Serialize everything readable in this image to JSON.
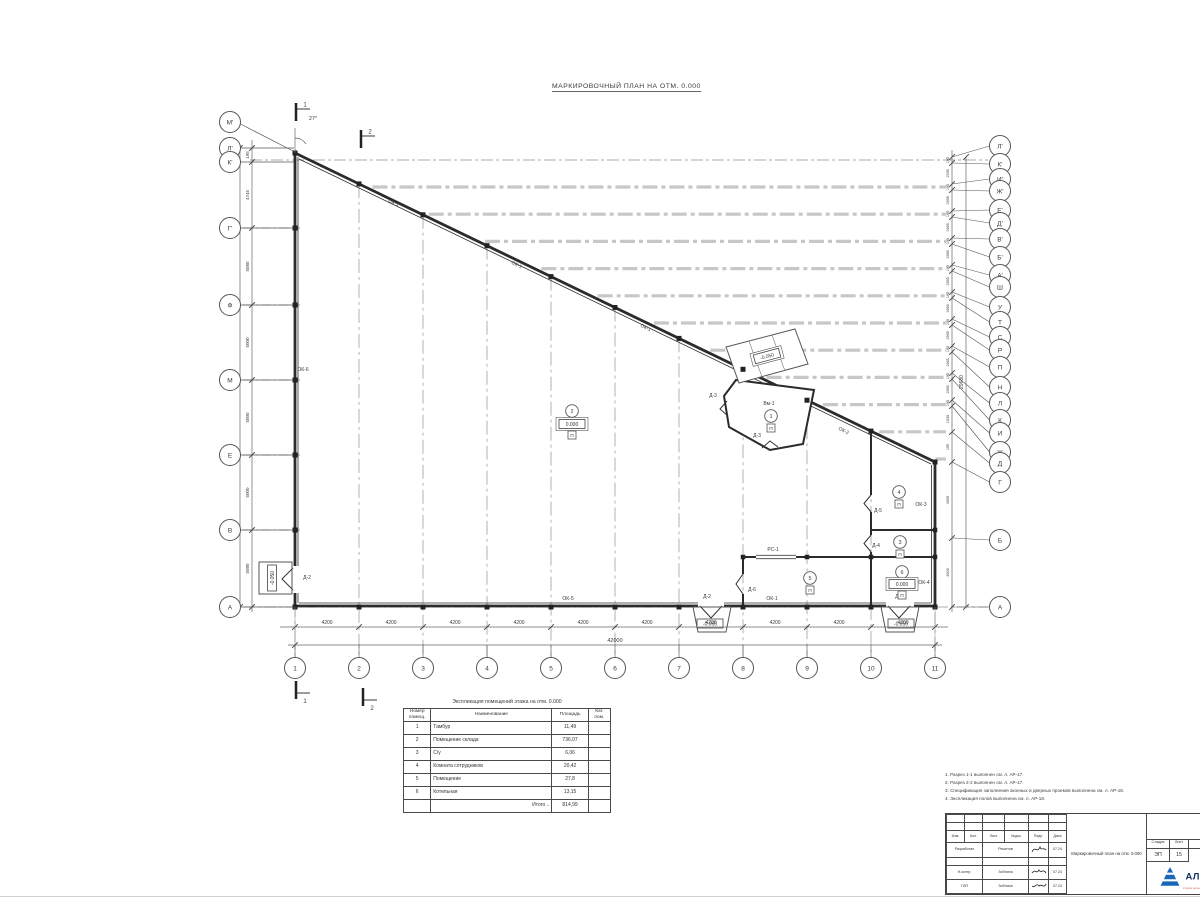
{
  "title": "МАРКИРОВОЧНЫЙ ПЛАН НА ОТМ. 0.000",
  "plan": {
    "angle_label": "27°",
    "axes_left": [
      "М'",
      "Л'",
      "К'",
      "Г'",
      "Ф",
      "М",
      "Е",
      "В",
      "А"
    ],
    "axes_right": [
      "Л'",
      "К'",
      "И'",
      "Ж'",
      "Е'",
      "Д'",
      "В'",
      "Б'",
      "А'",
      "Ш",
      "У",
      "Т",
      "С",
      "Р",
      "П",
      "Н",
      "Л",
      "К",
      "И",
      "Ж",
      "Д",
      "Г",
      "Б",
      "А"
    ],
    "axes_bottom": [
      "1",
      "2",
      "3",
      "4",
      "5",
      "6",
      "7",
      "8",
      "9",
      "10",
      "11"
    ],
    "section_marks": [
      "1",
      "2"
    ],
    "dim_bottom_segments": [
      "4200",
      "4200",
      "4200",
      "4200",
      "4200",
      "4200",
      "4200",
      "4200",
      "4200",
      "4200"
    ],
    "dim_bottom_total": "42000",
    "dim_left_segments": [
      "195",
      "4745",
      "5080",
      "5000",
      "5000",
      "5000",
      "5080"
    ],
    "dim_left_total": "29680",
    "dim_right_segments": [
      "195",
      "1935",
      "195",
      "1965",
      "195",
      "1965",
      "195",
      "1965",
      "195",
      "1965",
      "195",
      "1965",
      "195",
      "1965",
      "195",
      "1965",
      "195",
      "1965",
      "195",
      "1935",
      "195",
      "4905",
      "4500"
    ],
    "dim_right_total": "29680",
    "wall_labels": [
      "ОК-1",
      "ОК-1",
      "ОК-1",
      "ОК-2",
      "ОК-6",
      "ОК-5",
      "ОК-1",
      "Д-2",
      "Д-1",
      "ОК-3",
      "ОК-4",
      "Д-5",
      "Д-4",
      "Д-6",
      "РС-1",
      "Д-3",
      "Д-3",
      "Вм-1",
      "Д-2"
    ],
    "rooms": [
      {
        "num": "1",
        "floor": "П"
      },
      {
        "num": "2",
        "elev": "0.000",
        "floor": "П"
      },
      {
        "num": "3",
        "floor": "П"
      },
      {
        "num": "4",
        "floor": "П"
      },
      {
        "num": "5",
        "floor": "П"
      },
      {
        "num": "6",
        "elev": "0.000",
        "floor": "П"
      }
    ],
    "elevation_marks": [
      "-0.050",
      "-0.050",
      "-0.050",
      "-0.050"
    ]
  },
  "schedule": {
    "caption": "Экспликация помещений этажа на отм. 0.000",
    "headers": {
      "num1": "Номер",
      "num2": "помещ.",
      "name": "Наименование",
      "area": "Площадь",
      "cat1": "Кат.",
      "cat2": "пом."
    },
    "rows": [
      [
        "1",
        "Тамбур",
        "11,49"
      ],
      [
        "2",
        "Помещение склада",
        "736,07"
      ],
      [
        "3",
        "С/у",
        "6,06"
      ],
      [
        "4",
        "Комната сотрудников",
        "20,42"
      ],
      [
        "5",
        "Помещение",
        "27,8"
      ],
      [
        "6",
        "Котельная",
        "13,15"
      ]
    ],
    "total_label": "Итого ..",
    "total_value": "814,99"
  },
  "notes": {
    "items": [
      "1. Разрез 1-1 выполнен см. л. АР-17.",
      "2. Разрез 2-2 выполнен см. л. АР-17.",
      "3. Спецификация заполнения оконных и дверных проемов выполнена см. л. АР-18.",
      "4. Экспликация полов выполнена см. л. АР-18."
    ]
  },
  "titleblock": {
    "columns": [
      "Изм.",
      "Кол.",
      "Лист",
      "№док.",
      "Подп.",
      "Дата"
    ],
    "rows": [
      {
        "role": "Разработал",
        "name": "Решетов",
        "date": "07.24"
      },
      {
        "role": "Н.контр.",
        "name": "Зобнина",
        "date": "07.24"
      },
      {
        "role": "ГИП",
        "name": "Зобнина",
        "date": "07.24"
      }
    ],
    "doc_name": "Маркировочный план на отм. 0.000",
    "stage_label": "Стадия",
    "stage": "ЭП",
    "sheet_label": "Лист",
    "sheet": "15",
    "logo_text": "АЛЬЯНС",
    "logo_sub": "строительная компания",
    "logo_color": "#1a66b8",
    "logo_sub_color": "#c0392b"
  }
}
